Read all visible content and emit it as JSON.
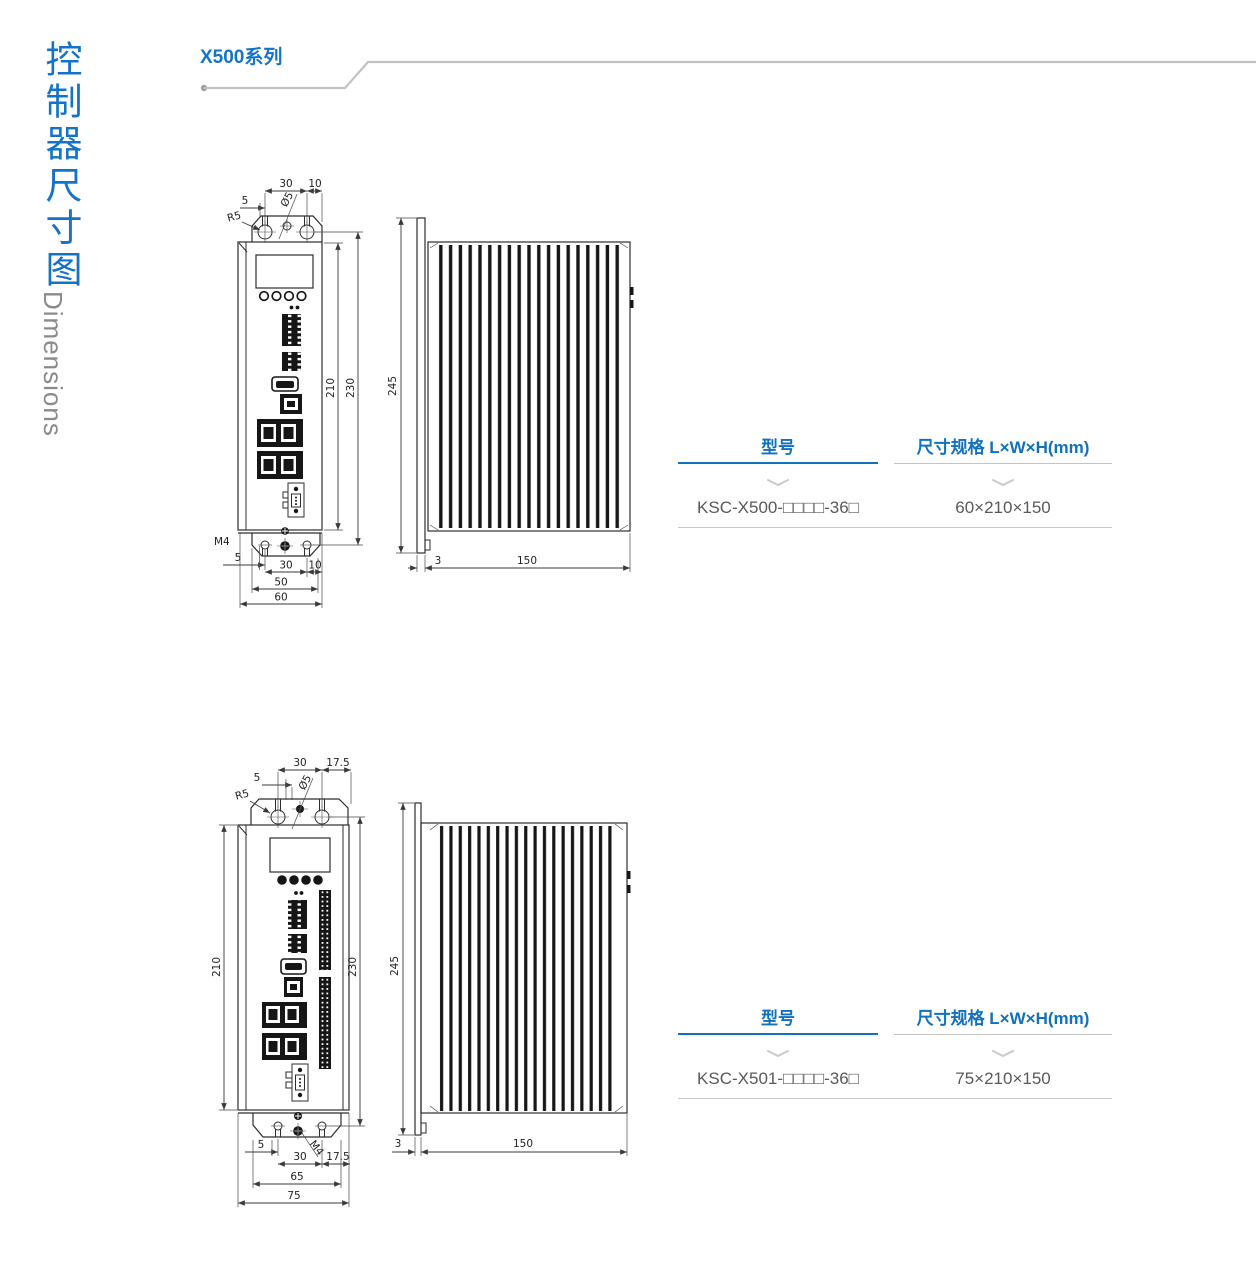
{
  "sidebar": {
    "title_cn": "控制器尺寸图",
    "title_en": "Dimensions"
  },
  "header": {
    "series_label": "X500系列"
  },
  "colors": {
    "accent_blue": "#1373c8",
    "table_header_blue": "#1072bd",
    "table_text_gray": "#58595b",
    "rule_gray": "#c2c2c2",
    "drawing_line": "#2d2d2d"
  },
  "drawing1": {
    "front": {
      "top_width": "30",
      "top_offset": "10",
      "top_edge": "5",
      "hole_dia": "Ø5",
      "corner_radius": "R5",
      "height_body": "210",
      "height_bracket": "230",
      "screw": "M4",
      "bottom_edge": "5",
      "bottom_width": "30",
      "bottom_offset": "10",
      "bottom_span": "50",
      "total_width": "60"
    },
    "side": {
      "height": "245",
      "plate_thickness": "3",
      "depth": "150"
    }
  },
  "drawing2": {
    "front": {
      "top_width": "30",
      "top_offset": "17.5",
      "top_edge": "5",
      "hole_dia": "Ø5",
      "corner_radius": "R5",
      "height_body": "210",
      "height_bracket": "230",
      "screw": "M4",
      "bottom_edge": "5",
      "bottom_width": "30",
      "bottom_offset": "17.5",
      "bottom_span": "65",
      "total_width": "75"
    },
    "side": {
      "height": "245",
      "plate_thickness": "3",
      "depth": "150"
    }
  },
  "table1": {
    "col1_header": "型号",
    "col2_header": "尺寸规格 L×W×H(mm)",
    "model": "KSC-X500-□□□□-36□",
    "size": "60×210×150"
  },
  "table2": {
    "col1_header": "型号",
    "col2_header": "尺寸规格 L×W×H(mm)",
    "model": "KSC-X501-□□□□-36□",
    "size": "75×210×150"
  }
}
